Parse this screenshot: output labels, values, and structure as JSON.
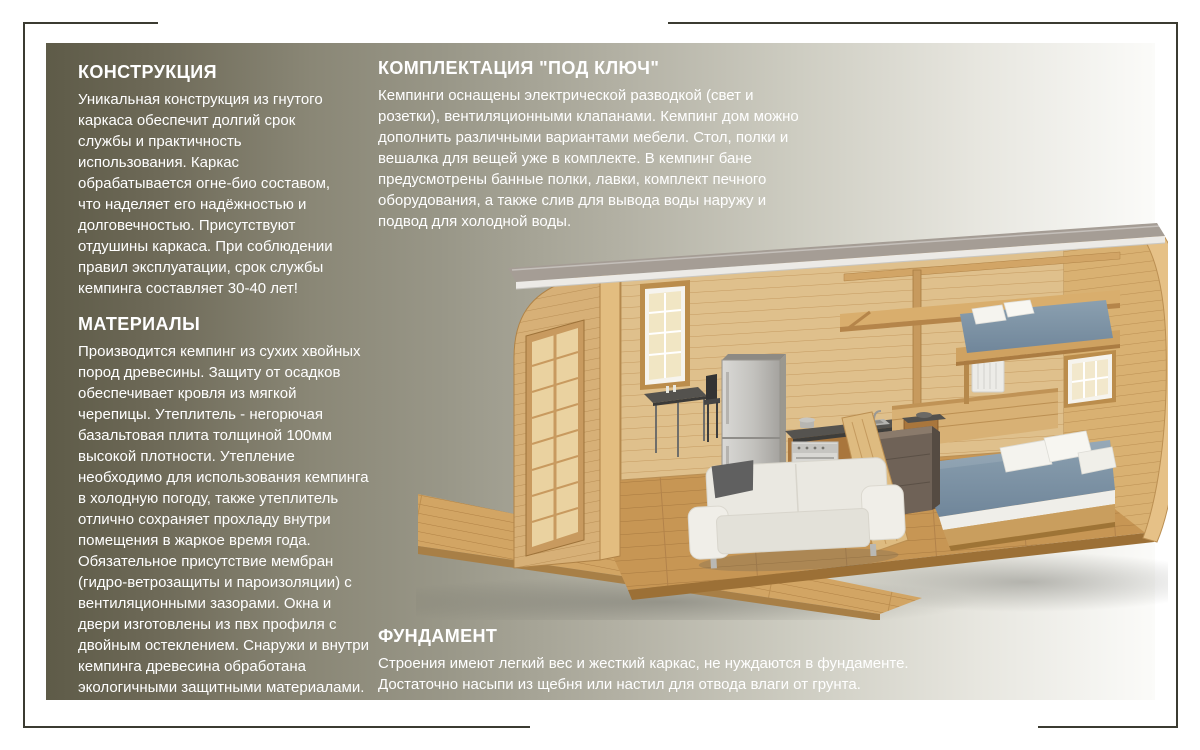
{
  "canvas": {
    "background": "#ffffff",
    "frame_color": "#3b3b31",
    "panel_gradient": [
      "#5e5b48",
      "#999788",
      "#fbfbf9"
    ],
    "text_color": "#ffffff"
  },
  "sections": {
    "construction": {
      "title": "КОНСТРУКЦИЯ",
      "body": "Уникальная конструкция из гнутого\nкаркаса обеспечит долгий срок\nслужбы и практичность\nиспользования. Каркас\nобрабатывается огне-био составом,\nчто наделяет его надёжностью и\nдолговечностью. Присутствуют\nотдушины каркаса. При соблюдении\nправил эксплуатации, срок службы\nкемпинга составляет 30-40 лет!"
    },
    "materials": {
      "title": "МАТЕРИАЛЫ",
      "body": "Производится кемпинг из сухих хвойных\nпород древесины. Защиту от осадков\nобеспечивает кровля из мягкой\nчерепицы.  Утеплитель - негорючая\nбазальтовая плита толщиной 100мм\nвысокой плотности. Утепление\nнеобходимо для использования кемпинга\nв холодную погоду, также утеплитель\nотлично сохраняет прохладу внутри\nпомещения в жаркое время года.\nОбязательное присутствие мембран\n(гидро-ветрозащиты и пароизоляции) с\nвентиляционными зазорами. Окна и\nдвери изготовлены из пвх профиля с\nдвойным остеклением. Снаружи и внутри\nкемпинга древесина обработана\nэкологичными  защитными материалами."
    },
    "equipment": {
      "title": "КОМПЛЕКТАЦИЯ \"ПОД КЛЮЧ\"",
      "body": "Кемпинги оснащены электрической разводкой (свет и\nрозетки), вентиляционными клапанами. Кемпинг дом можно\nдополнить различными вариантами мебели. Стол, полки и\nвешалка для вещей уже в комплекте. В кемпинг бане\nпредусмотрены банные полки, лавки, комплект печного\nоборудования, а также слив для вывода воды наружу и\nподвод для холодной воды."
    },
    "foundation": {
      "title": "ФУНДАМЕНТ",
      "body": "Строения имеют легкий вес и жесткий каркас, не нуждаются в фундаменте.\nДостаточно насыпи из щебня или настил для отвода влаги от грунта."
    }
  },
  "illustration": {
    "alt": "3D cutaway of an arched wooden camping house with deck, glazed door, kitchen, dining table, sofa, double bed and loft bed",
    "colors": {
      "wood_light": "#d7b077",
      "wood_mid": "#c79a5e",
      "wood_dark": "#a9763c",
      "roof": "#a59d95",
      "fascia": "#eceae6",
      "bedding": "#8296a7",
      "pillows": "#f5f4ef",
      "sofa": "#eae8e1",
      "fridge": "#c9c8c5",
      "counter": "#55534f",
      "dresser": "#6f6257",
      "shadow": "#8a8a82"
    },
    "objects": [
      "deck",
      "glazed-door",
      "left-window",
      "right-window",
      "dining-table",
      "chairs",
      "fridge",
      "stove",
      "sink",
      "kitchen-counter",
      "loft-shelf",
      "loft-bed",
      "double-bed",
      "sofa",
      "dresser",
      "radiator",
      "arch-ribs",
      "roof"
    ]
  }
}
